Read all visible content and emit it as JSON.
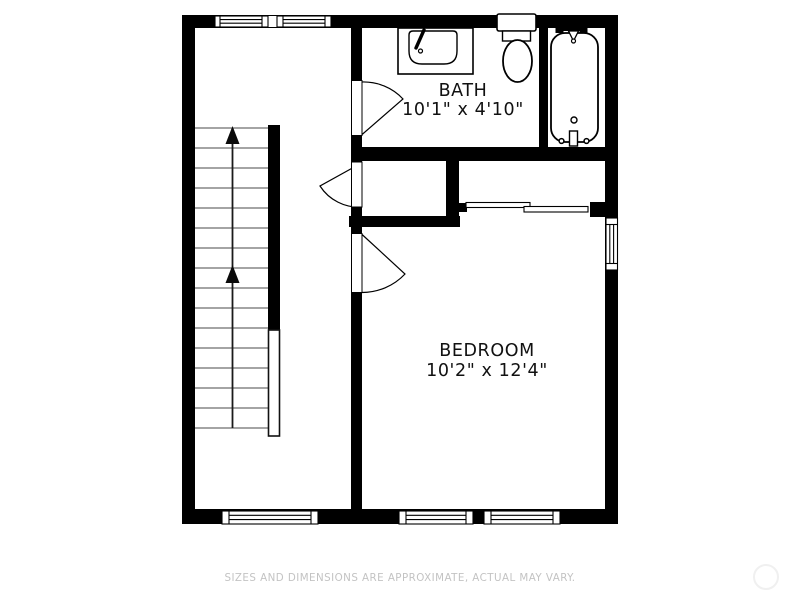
{
  "floor_plan": {
    "rooms": [
      {
        "label": "BATH",
        "dimensions": "10'1\" x 4'10\""
      },
      {
        "label": "BEDROOM",
        "dimensions": "10'2\" x 12'4\""
      }
    ],
    "stairs": {
      "direction": "up",
      "arrow_count": 2
    },
    "fixtures": [
      "sink",
      "toilet",
      "bathtub"
    ],
    "doors": [
      "bath-swing-door",
      "closet-swing-door",
      "bedroom-swing-door",
      "closet-sliding-door"
    ],
    "windows": [
      "top-double-window",
      "right-window",
      "bottom-window-hall",
      "bottom-window-bedroom-left",
      "bottom-window-bedroom-right"
    ]
  },
  "footer": {
    "disclaimer": "SIZES AND DIMENSIONS ARE APPROXIMATE, ACTUAL MAY VARY."
  },
  "colors": {
    "wall": "#000000",
    "background": "#ffffff",
    "disclaimer_text": "#c3c3c3",
    "stair_tread": "#4a4a4a"
  }
}
